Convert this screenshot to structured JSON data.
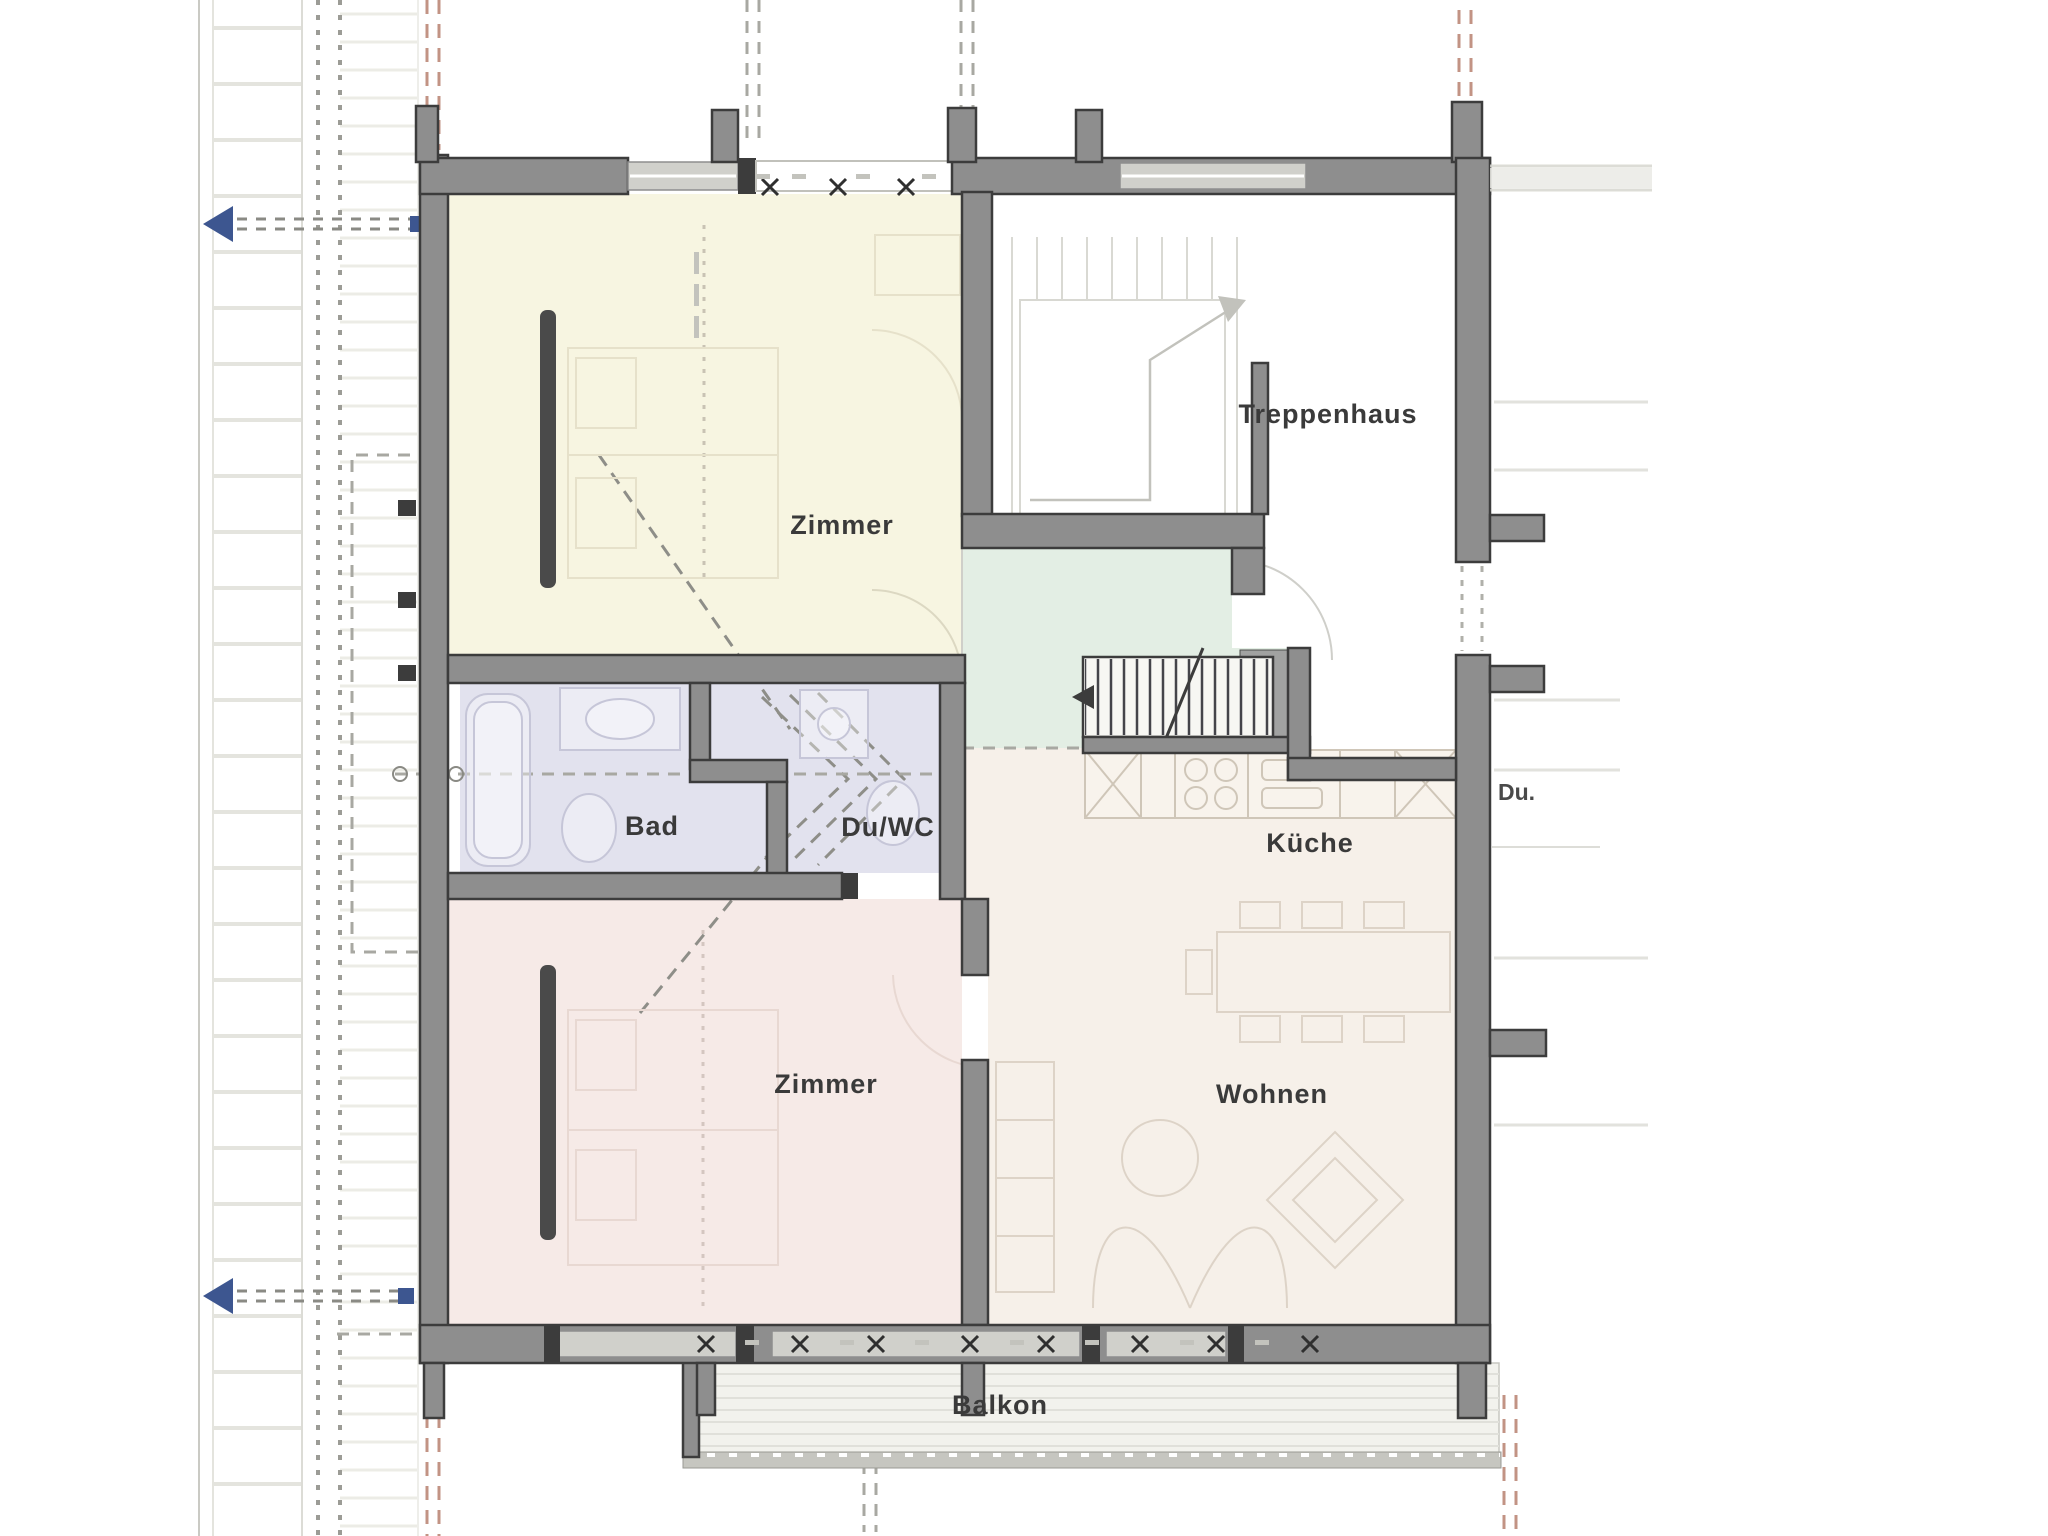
{
  "rooms": {
    "zimmer_top": {
      "label": "Zimmer"
    },
    "treppenhaus": {
      "label": "Treppenhaus"
    },
    "bad": {
      "label": "Bad"
    },
    "duwc": {
      "label": "Du/WC"
    },
    "kueche": {
      "label": "Küche"
    },
    "wohnen": {
      "label": "Wohnen"
    },
    "zimmer_bottom": {
      "label": "Zimmer"
    },
    "balkon": {
      "label": "Balkon"
    }
  },
  "context": {
    "neighbor_room_label": "Du."
  },
  "colors": {
    "wall_stroke": "#3c3c3c",
    "wall_fill": "#8e8e8e",
    "wall_window": "#d0d0cb",
    "room_zimmer_top": "#f7f5e1",
    "room_zimmer_bottom": "#f6eae7",
    "room_bath": "#e2e2ee",
    "room_entree": "#e3eee4",
    "room_living": "#f6f0e9",
    "balcony_deck": "#f2f2ed",
    "axis_red": "#c29384",
    "marker_blue": "#3d5690",
    "label_text": "#3a3a3a",
    "context_gray": "#e4e4de",
    "dash_gray": "#a8a8a2"
  }
}
